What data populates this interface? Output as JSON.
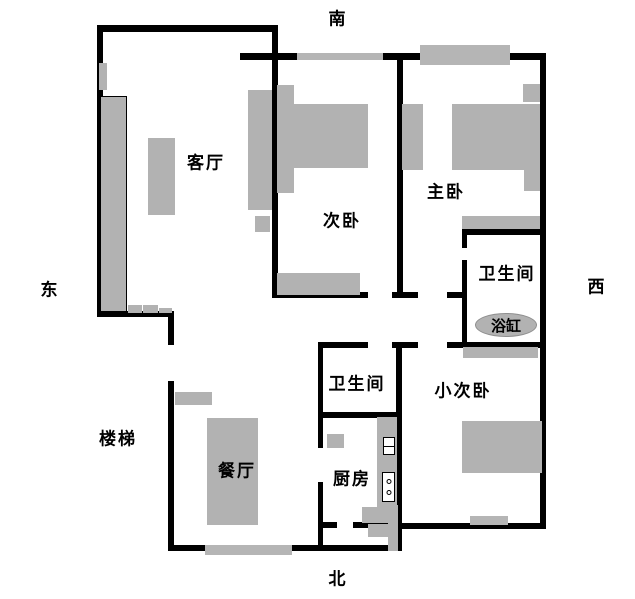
{
  "title": "apartment-floor-plan",
  "compass": {
    "south": "南",
    "north": "北",
    "east": "东",
    "west": "西"
  },
  "rooms": {
    "living_room": "客厅",
    "second_bedroom": "次卧",
    "master_bedroom": "主卧",
    "master_bathroom": "卫生间",
    "bathtub": "浴缸",
    "small_bedroom": "小次卧",
    "middle_bathroom": "卫生间",
    "kitchen": "厨房",
    "dining_room": "餐厅",
    "stairs": "楼梯"
  },
  "colors": {
    "wall": "#000000",
    "furniture": "#b2b2b2",
    "background": "#ffffff"
  }
}
